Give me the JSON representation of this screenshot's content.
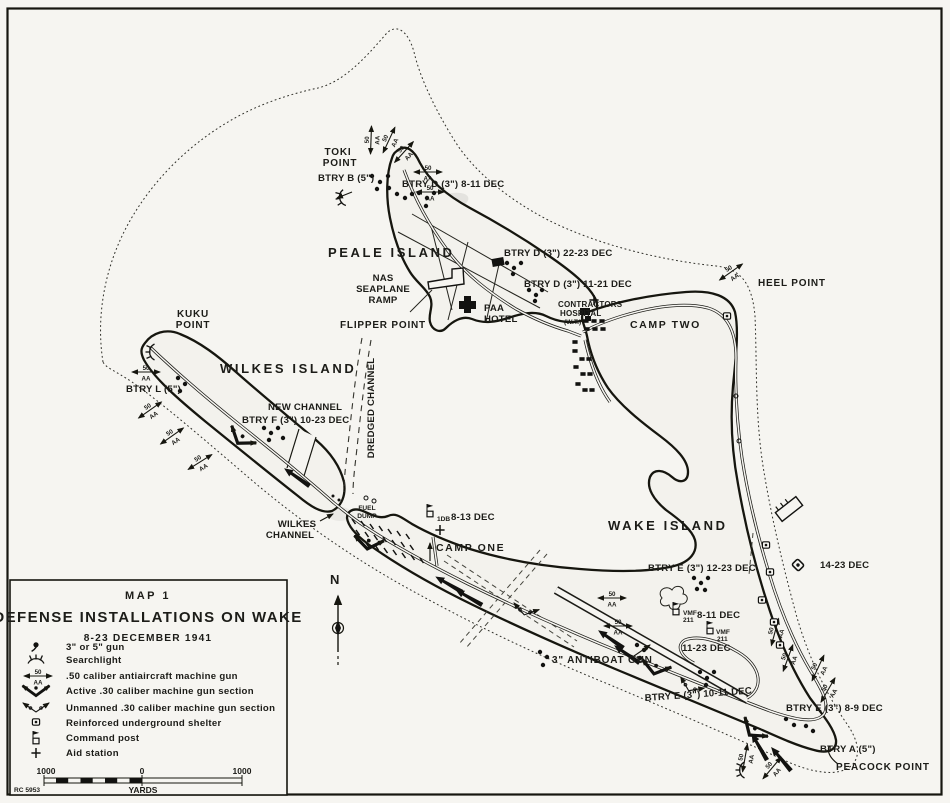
{
  "title_block": {
    "map_no": "MAP 1",
    "title": "DEFENSE INSTALLATIONS ON WAKE",
    "subtitle": "8-23 DECEMBER 1941",
    "legend_items": [
      "3\" or 5\" gun",
      "Searchlight",
      ".50 caliber antiaircraft machine gun",
      "Active .30 caliber machine gun section",
      "Unmanned .30 caliber machine gun section",
      "Reinforced underground shelter",
      "Command post",
      "Aid station"
    ],
    "scale": {
      "left": "1000",
      "middle": "0",
      "right": "1000",
      "units": "YARDS"
    },
    "plate_ref": "RC 5953"
  },
  "compass": {
    "north": "N"
  },
  "symbols": {
    "aa_num": "50",
    "aa_label": "AA"
  },
  "islands": {
    "peale": "PEALE ISLAND",
    "wilkes": "WILKES ISLAND",
    "wake": "WAKE ISLAND"
  },
  "points": {
    "toki_1": "TOKI",
    "toki_2": "POINT",
    "kuku_1": "KUKU",
    "kuku_2": "POINT",
    "heel": "HEEL POINT",
    "flipper": "FLIPPER POINT",
    "peacock": "PEACOCK POINT"
  },
  "channels": {
    "wilkes_1": "WILKES",
    "wilkes_2": "CHANNEL",
    "new_channel": "NEW CHANNEL",
    "dredged": "DREDGED CHANNEL"
  },
  "facilities": {
    "nas_1": "NAS",
    "nas_2": "SEAPLANE",
    "nas_3": "RAMP",
    "paa_1": "PAA",
    "paa_2": "HOTEL",
    "hospital_1": "CONTRACTORS",
    "hospital_2": "HOSPITAL",
    "hospital_3": "(W.T.)",
    "camp_one": "CAMP ONE",
    "camp_two": "CAMP TWO",
    "fuel_1": "FUEL",
    "fuel_2": "DUMP",
    "antiboat": "3\" ANTIBOAT GUN"
  },
  "batteries": {
    "btry_a": "BTRY A (5\")",
    "btry_b": "BTRY B (5\")",
    "btry_l": "BTRY L (5\")",
    "btry_d_8_11": "BTRY D (3\") 8-11 DEC",
    "btry_d_22_23": "BTRY D (3\") 22-23 DEC",
    "btry_d_11_21": "BTRY D (3\") 11-21 DEC",
    "btry_f": "BTRY F (3\") 10-23 DEC",
    "btry_e_12_23": "BTRY E (3\") 12-23 DEC",
    "btry_e_10_11": "BTRY E (3\") 10-11 DEC",
    "btry_e_8_9": "BTRY E (3\") 8-9 DEC"
  },
  "posts": {
    "cp_1db_unit": "1DB",
    "cp_1db_date": "8-13 DEC",
    "vmf_unit": "VMF",
    "vmf_num": "211",
    "vmf_1_date": "8-11 DEC",
    "vmf_2_date": "11-23 DEC",
    "shelter_date": "14-23 DEC"
  }
}
